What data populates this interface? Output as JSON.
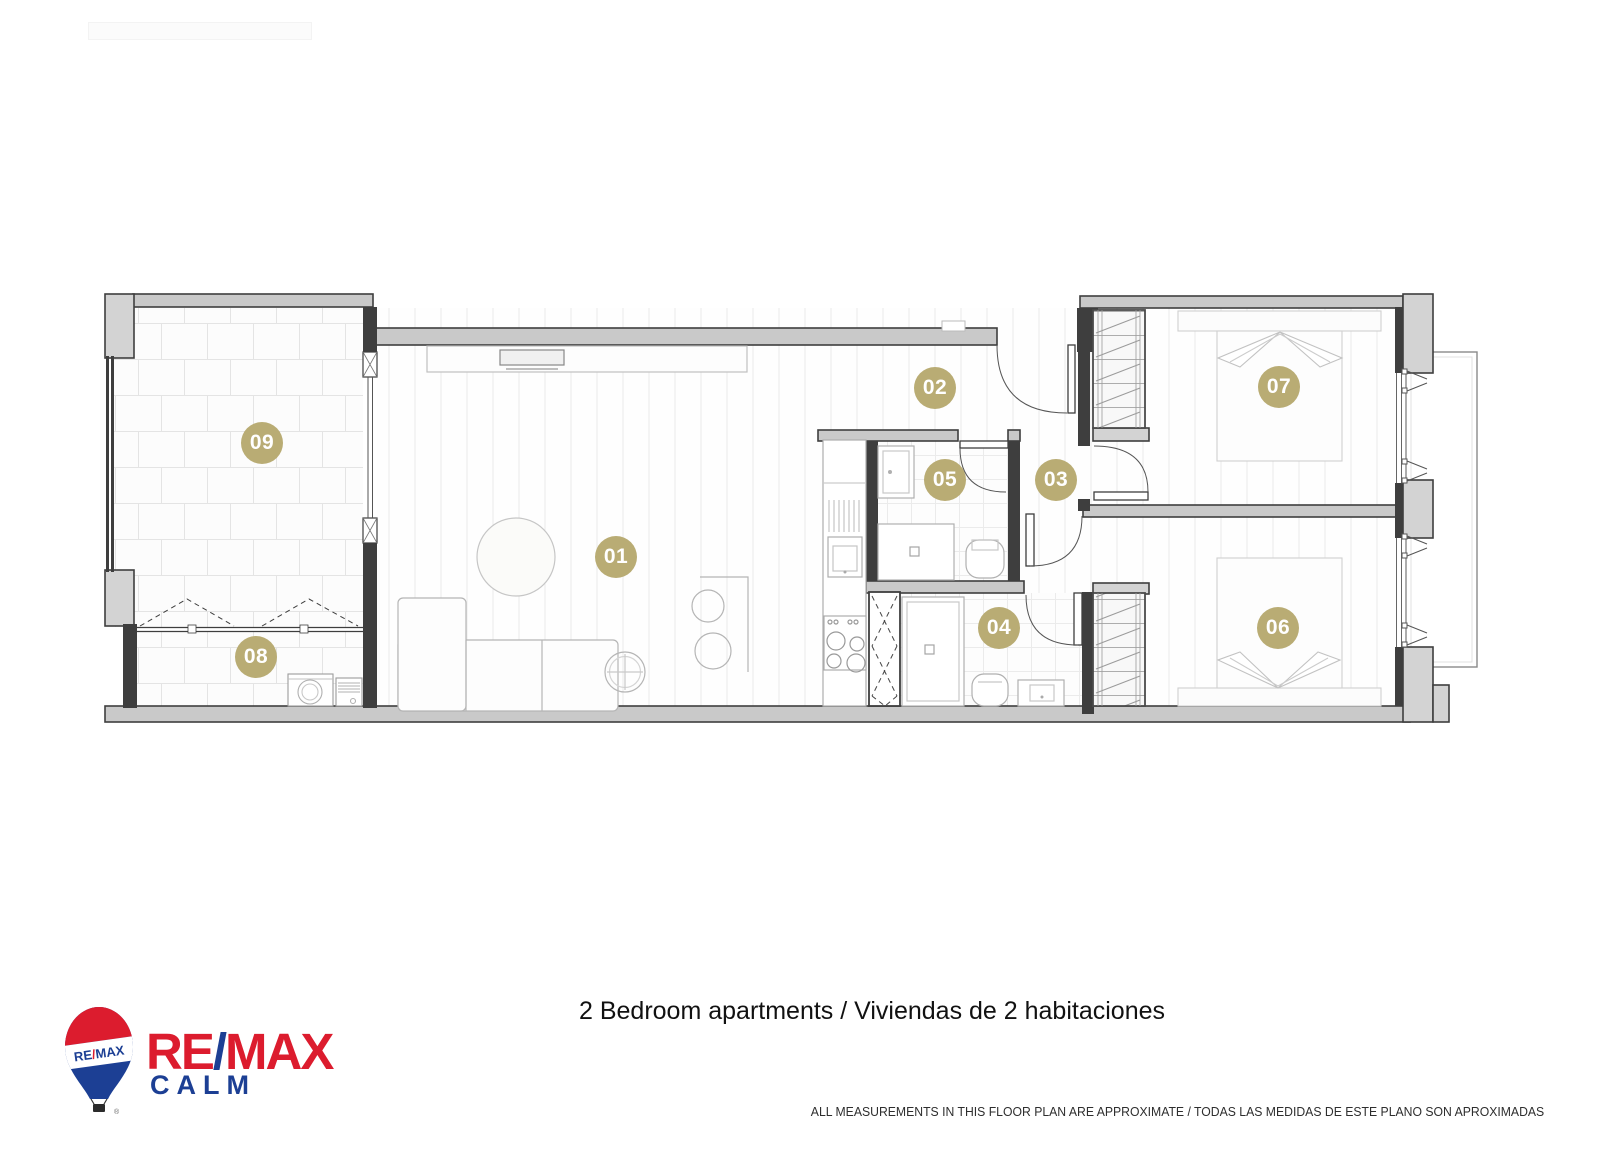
{
  "title": "2 Bedroom apartments / Viviendas de 2 habitaciones",
  "disclaimer": "ALL MEASUREMENTS IN THIS FLOOR PLAN ARE APPROXIMATE / TODAS LAS MEDIDAS DE ESTE PLANO SON APROXIMADAS",
  "logo": {
    "re": "RE",
    "slash": "/",
    "max": "MAX",
    "office": "CALM",
    "balloon_re": "RE",
    "balloon_slash": "/",
    "balloon_max": "MAX",
    "registered": "®",
    "colors": {
      "red": "#dc1c2e",
      "blue": "#1c3f94"
    }
  },
  "floor_plan": {
    "marker_color": "#b9ac74",
    "rooms": [
      {
        "number": "01"
      },
      {
        "number": "02"
      },
      {
        "number": "03"
      },
      {
        "number": "04"
      },
      {
        "number": "05"
      },
      {
        "number": "06"
      },
      {
        "number": "07"
      },
      {
        "number": "08"
      },
      {
        "number": "09"
      }
    ]
  }
}
